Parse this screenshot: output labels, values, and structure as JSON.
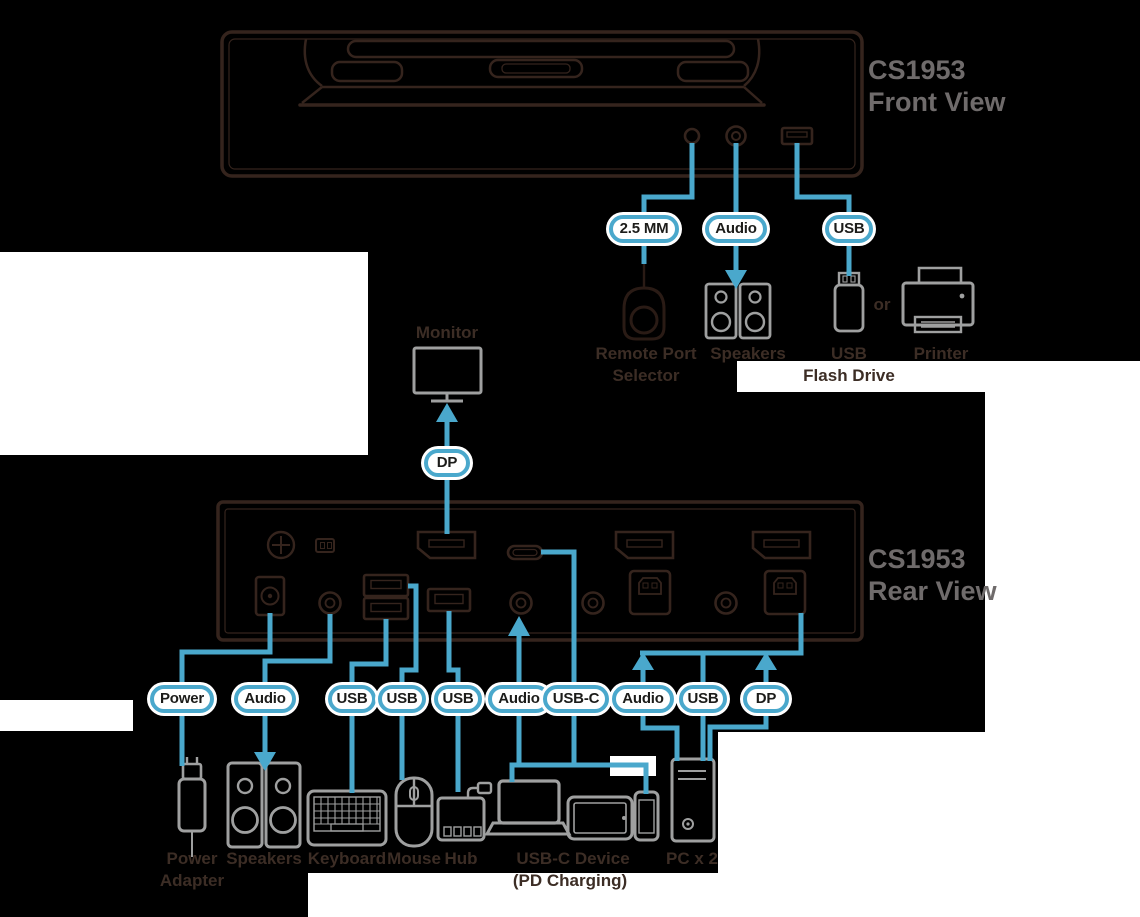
{
  "front_view": {
    "model": "CS1953",
    "view": "Front View"
  },
  "rear_view": {
    "model": "CS1953",
    "view": "Rear View"
  },
  "pills": {
    "front": [
      "2.5 MM",
      "Audio",
      "USB"
    ],
    "monitor": "DP",
    "rear": [
      "Power",
      "Audio",
      "USB",
      "USB",
      "USB",
      "Audio",
      "USB-C",
      "Audio",
      "USB",
      "DP"
    ]
  },
  "labels": {
    "monitor": "Monitor",
    "remote_line1": "Remote Port",
    "remote_line2": "Selector",
    "speakers_top": "Speakers",
    "usb_flash_line1": "USB",
    "usb_flash_line2": "Flash Drive",
    "or": "or",
    "printer": "Printer",
    "power_line1": "Power",
    "power_line2": "Adapter",
    "speakers_bottom": "Speakers",
    "keyboard": "Keyboard",
    "mouse": "Mouse",
    "hub": "Hub",
    "usbc_device_line1": "USB-C Device",
    "usbc_device_line2": "(PD Charging)",
    "pc": "PC x 2"
  },
  "colors": {
    "background": "#000000",
    "accent_blue": "#4AA8CC",
    "line_art": "#35241D",
    "grey_icon": "#9FA0A0",
    "label_text": "#3C2D25",
    "model_text": "#6F6B6B",
    "pill_fill": "#FFFFFF"
  }
}
